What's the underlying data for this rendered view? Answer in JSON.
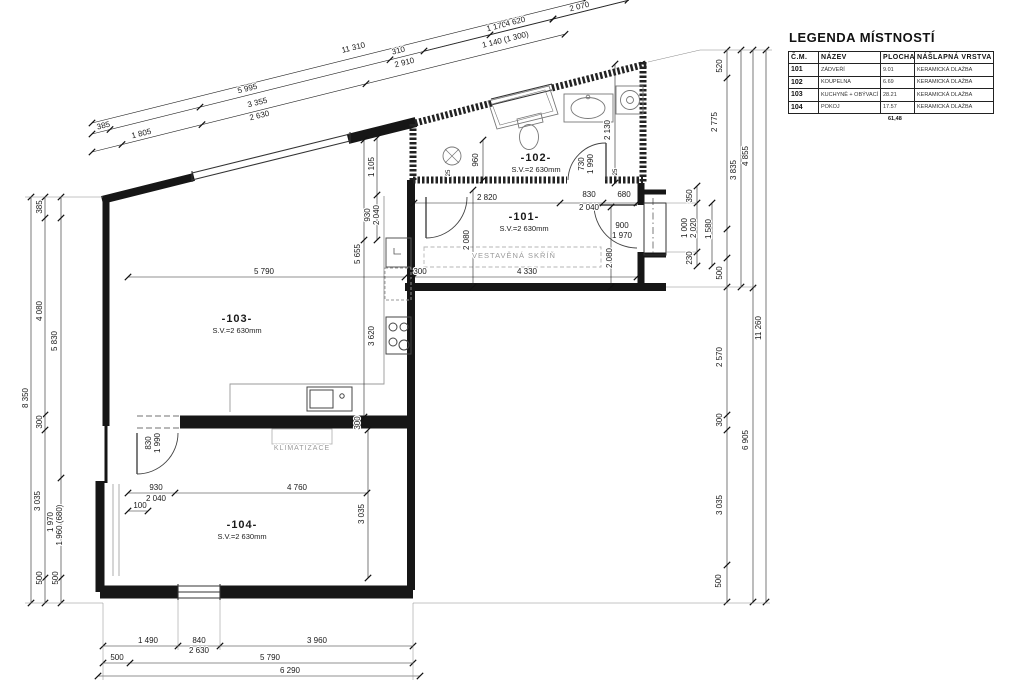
{
  "legend": {
    "title": "LEGENDA MÍSTNOSTÍ",
    "columns": [
      "Č.M.",
      "NÁZEV",
      "PLOCHA",
      "NÁŠLAPNÁ VRSTVA"
    ],
    "rows": [
      [
        "101",
        "ZÁDVEŘÍ",
        "9.01",
        "KERAMICKÁ DLAŽBA"
      ],
      [
        "102",
        "KOUPELNA",
        "6.69",
        "KERAMICKÁ DLAŽBA"
      ],
      [
        "103",
        "KUCHYNĚ + OBÝVACÍ POKOJ",
        "28.21",
        "KERAMICKÁ DLAŽBA"
      ],
      [
        "104",
        "POKOJ",
        "17.57",
        "KERAMICKÁ DLAŽBA"
      ]
    ],
    "total": "61,48"
  },
  "rooms": [
    {
      "id": "-101-",
      "height_note": "S.V.=2 630mm",
      "x": 524,
      "y": 220
    },
    {
      "id": "-102-",
      "height_note": "S.V.=2 630mm",
      "x": 536,
      "y": 161
    },
    {
      "id": "-103-",
      "height_note": "S.V.=2 630mm",
      "x": 237,
      "y": 322
    },
    {
      "id": "-104-",
      "height_note": "S.V.=2 630mm",
      "x": 242,
      "y": 528
    }
  ],
  "annotations": [
    {
      "t": "VESTAVĚNÁ SKŘÍŇ",
      "x": 514,
      "y": 258,
      "s": 7.5
    },
    {
      "t": "KLIMATIZACE",
      "x": 302,
      "y": 450,
      "s": 7
    }
  ],
  "dim_labels": [
    {
      "t": "385",
      "x": 104,
      "y": 128,
      "r": -14
    },
    {
      "t": "1 805",
      "x": 142,
      "y": 136,
      "r": -14
    },
    {
      "t": "11 310",
      "x": 354,
      "y": 50,
      "r": -14
    },
    {
      "t": "5 995",
      "x": 248,
      "y": 91,
      "r": -14
    },
    {
      "t": "3 355",
      "x": 258,
      "y": 105,
      "r": -14
    },
    {
      "t": "2 630",
      "x": 260,
      "y": 118,
      "r": -14
    },
    {
      "t": "310",
      "x": 399,
      "y": 53,
      "r": -14
    },
    {
      "t": "2 910",
      "x": 405,
      "y": 65,
      "r": -14
    },
    {
      "t": "1 170",
      "x": 497,
      "y": 29,
      "r": -14
    },
    {
      "t": "1 140 (1 300)",
      "x": 506,
      "y": 42,
      "r": -14
    },
    {
      "t": "4 620",
      "x": 516,
      "y": 24,
      "r": -14
    },
    {
      "t": "2 070",
      "x": 580,
      "y": 9,
      "r": -14
    },
    {
      "t": "1 105",
      "x": 374,
      "y": 167,
      "r": -90
    },
    {
      "t": "930",
      "x": 370,
      "y": 215,
      "r": -90
    },
    {
      "t": "2 040",
      "x": 379,
      "y": 215,
      "r": -90
    },
    {
      "t": "960",
      "x": 478,
      "y": 160,
      "r": -90
    },
    {
      "t": "2 130",
      "x": 610,
      "y": 130,
      "r": -90
    },
    {
      "t": "730",
      "x": 584,
      "y": 164,
      "r": -90
    },
    {
      "t": "1 990",
      "x": 593,
      "y": 164,
      "r": -90
    },
    {
      "t": "25",
      "x": 450,
      "y": 173,
      "r": -90,
      "s": 6
    },
    {
      "t": "25",
      "x": 617,
      "y": 172,
      "r": -90,
      "s": 6
    },
    {
      "t": "2 080",
      "x": 469,
      "y": 240,
      "r": -90
    },
    {
      "t": "2 080",
      "x": 612,
      "y": 258,
      "r": -90
    },
    {
      "t": "350",
      "x": 692,
      "y": 196,
      "r": -90
    },
    {
      "t": "1 000",
      "x": 687,
      "y": 228,
      "r": -90
    },
    {
      "t": "2 020",
      "x": 696,
      "y": 228,
      "r": -90
    },
    {
      "t": "1 580",
      "x": 711,
      "y": 229,
      "r": -90
    },
    {
      "t": "230",
      "x": 692,
      "y": 258,
      "r": -90
    },
    {
      "t": "520",
      "x": 722,
      "y": 66,
      "r": -90
    },
    {
      "t": "2 775",
      "x": 717,
      "y": 122,
      "r": -90
    },
    {
      "t": "500",
      "x": 722,
      "y": 273,
      "r": -90
    },
    {
      "t": "2 570",
      "x": 722,
      "y": 357,
      "r": -90
    },
    {
      "t": "300",
      "x": 722,
      "y": 420,
      "r": -90
    },
    {
      "t": "3 035",
      "x": 722,
      "y": 505,
      "r": -90
    },
    {
      "t": "500",
      "x": 721,
      "y": 581,
      "r": -90
    },
    {
      "t": "3 835",
      "x": 736,
      "y": 170,
      "r": -90
    },
    {
      "t": "4 855",
      "x": 748,
      "y": 156,
      "r": -90
    },
    {
      "t": "6 905",
      "x": 748,
      "y": 440,
      "r": -90
    },
    {
      "t": "11 260",
      "x": 761,
      "y": 328,
      "r": -90
    },
    {
      "t": "8 350",
      "x": 28,
      "y": 398,
      "r": -90
    },
    {
      "t": "385",
      "x": 42,
      "y": 207,
      "r": -90
    },
    {
      "t": "4 080",
      "x": 42,
      "y": 311,
      "r": -90
    },
    {
      "t": "300",
      "x": 42,
      "y": 422,
      "r": -90
    },
    {
      "t": "3 035",
      "x": 40,
      "y": 501,
      "r": -90
    },
    {
      "t": "500",
      "x": 42,
      "y": 578,
      "r": -90
    },
    {
      "t": "5 830",
      "x": 57,
      "y": 341,
      "r": -90
    },
    {
      "t": "1 970",
      "x": 53,
      "y": 522,
      "r": -90
    },
    {
      "t": "1 960 (680)",
      "x": 62,
      "y": 525,
      "r": -90
    },
    {
      "t": "500",
      "x": 58,
      "y": 578,
      "r": -90
    },
    {
      "t": "5 655",
      "x": 360,
      "y": 254,
      "r": -90
    },
    {
      "t": "3 620",
      "x": 374,
      "y": 336,
      "r": -90
    },
    {
      "t": "300",
      "x": 360,
      "y": 423,
      "r": -90
    },
    {
      "t": "830",
      "x": 151,
      "y": 443,
      "r": -90
    },
    {
      "t": "1 990",
      "x": 160,
      "y": 443,
      "r": -90
    },
    {
      "t": "3 035",
      "x": 364,
      "y": 514,
      "r": -90
    },
    {
      "t": "2 820",
      "x": 487,
      "y": 200
    },
    {
      "t": "830",
      "x": 589,
      "y": 197
    },
    {
      "t": "2 040",
      "x": 589,
      "y": 210
    },
    {
      "t": "680",
      "x": 624,
      "y": 197
    },
    {
      "t": "900",
      "x": 622,
      "y": 228
    },
    {
      "t": "1 970",
      "x": 622,
      "y": 238
    },
    {
      "t": "4 330",
      "x": 527,
      "y": 274
    },
    {
      "t": "300",
      "x": 420,
      "y": 274
    },
    {
      "t": "5 790",
      "x": 264,
      "y": 274
    },
    {
      "t": "930",
      "x": 156,
      "y": 490
    },
    {
      "t": "2 040",
      "x": 156,
      "y": 501
    },
    {
      "t": "4 760",
      "x": 297,
      "y": 490
    },
    {
      "t": "100",
      "x": 140,
      "y": 508
    },
    {
      "t": "1 490",
      "x": 148,
      "y": 643
    },
    {
      "t": "840",
      "x": 199,
      "y": 643
    },
    {
      "t": "2 630",
      "x": 199,
      "y": 653
    },
    {
      "t": "3 960",
      "x": 317,
      "y": 643
    },
    {
      "t": "500",
      "x": 117,
      "y": 660
    },
    {
      "t": "5 790",
      "x": 270,
      "y": 660
    },
    {
      "t": "6 290",
      "x": 290,
      "y": 673
    }
  ]
}
